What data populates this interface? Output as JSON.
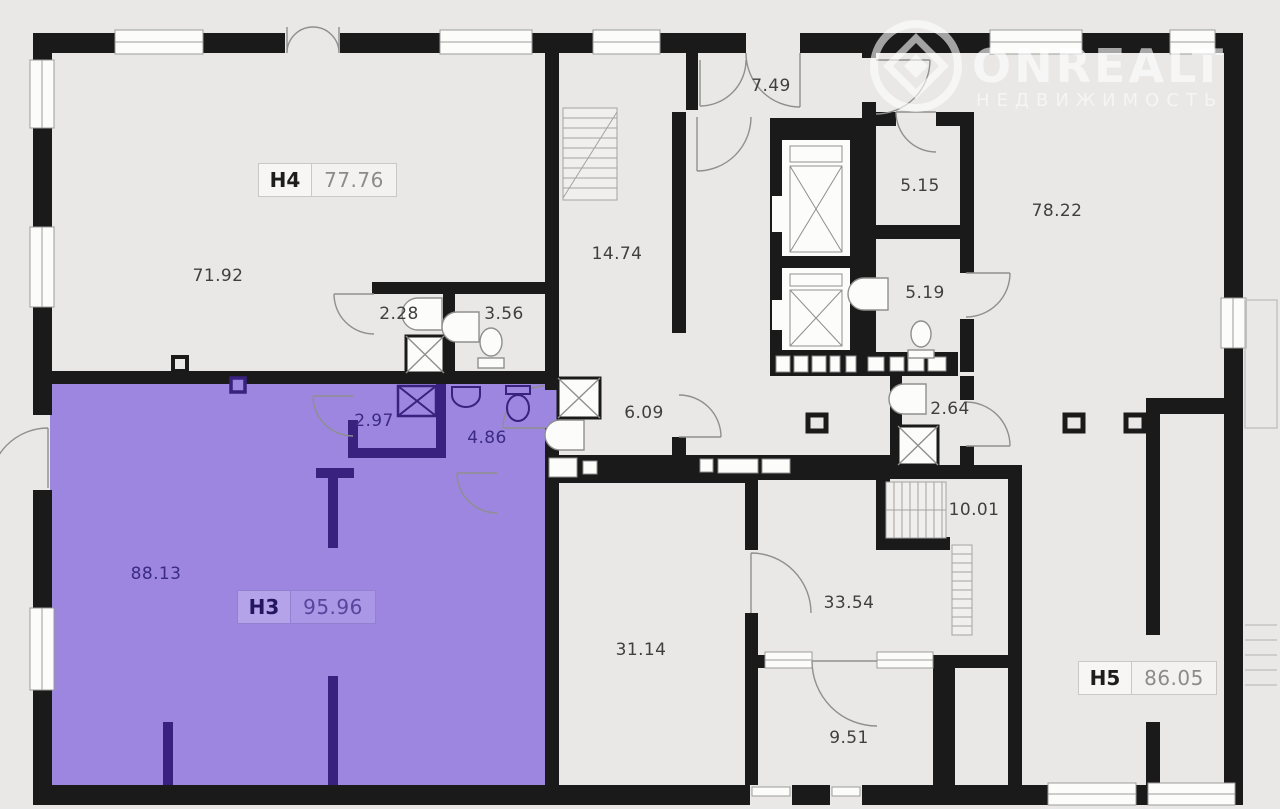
{
  "watermark": {
    "brand": "ONREALT",
    "subtitle": "НЕДВИЖИМОСТЬ"
  },
  "units": [
    {
      "id": "H4",
      "area": "77.76",
      "x": 258,
      "y": 163,
      "theme": "light"
    },
    {
      "id": "H3",
      "area": "95.96",
      "x": 237,
      "y": 590,
      "theme": "purple"
    },
    {
      "id": "H5",
      "area": "86.05",
      "x": 1078,
      "y": 661,
      "theme": "light"
    }
  ],
  "rooms": [
    {
      "area": "71.92",
      "x": 218,
      "y": 276
    },
    {
      "area": "7.49",
      "x": 771,
      "y": 86
    },
    {
      "area": "14.74",
      "x": 617,
      "y": 254
    },
    {
      "area": "2.28",
      "x": 399,
      "y": 314
    },
    {
      "area": "3.56",
      "x": 504,
      "y": 314
    },
    {
      "area": "5.15",
      "x": 920,
      "y": 186
    },
    {
      "area": "78.22",
      "x": 1057,
      "y": 211
    },
    {
      "area": "5.19",
      "x": 925,
      "y": 293
    },
    {
      "area": "6.09",
      "x": 644,
      "y": 413
    },
    {
      "area": "2.97",
      "x": 374,
      "y": 421,
      "theme": "purple"
    },
    {
      "area": "4.86",
      "x": 487,
      "y": 438,
      "theme": "purple"
    },
    {
      "area": "2.64",
      "x": 950,
      "y": 409
    },
    {
      "area": "88.13",
      "x": 156,
      "y": 574,
      "theme": "purple"
    },
    {
      "area": "10.01",
      "x": 974,
      "y": 510
    },
    {
      "area": "33.54",
      "x": 849,
      "y": 603
    },
    {
      "area": "31.14",
      "x": 641,
      "y": 650
    },
    {
      "area": "9.51",
      "x": 849,
      "y": 738
    }
  ],
  "colors": {
    "background": "#e9e8e6",
    "wall": "#1a1a1a",
    "highlight_fill": "#9c86df",
    "highlight_wall": "#38217f"
  }
}
